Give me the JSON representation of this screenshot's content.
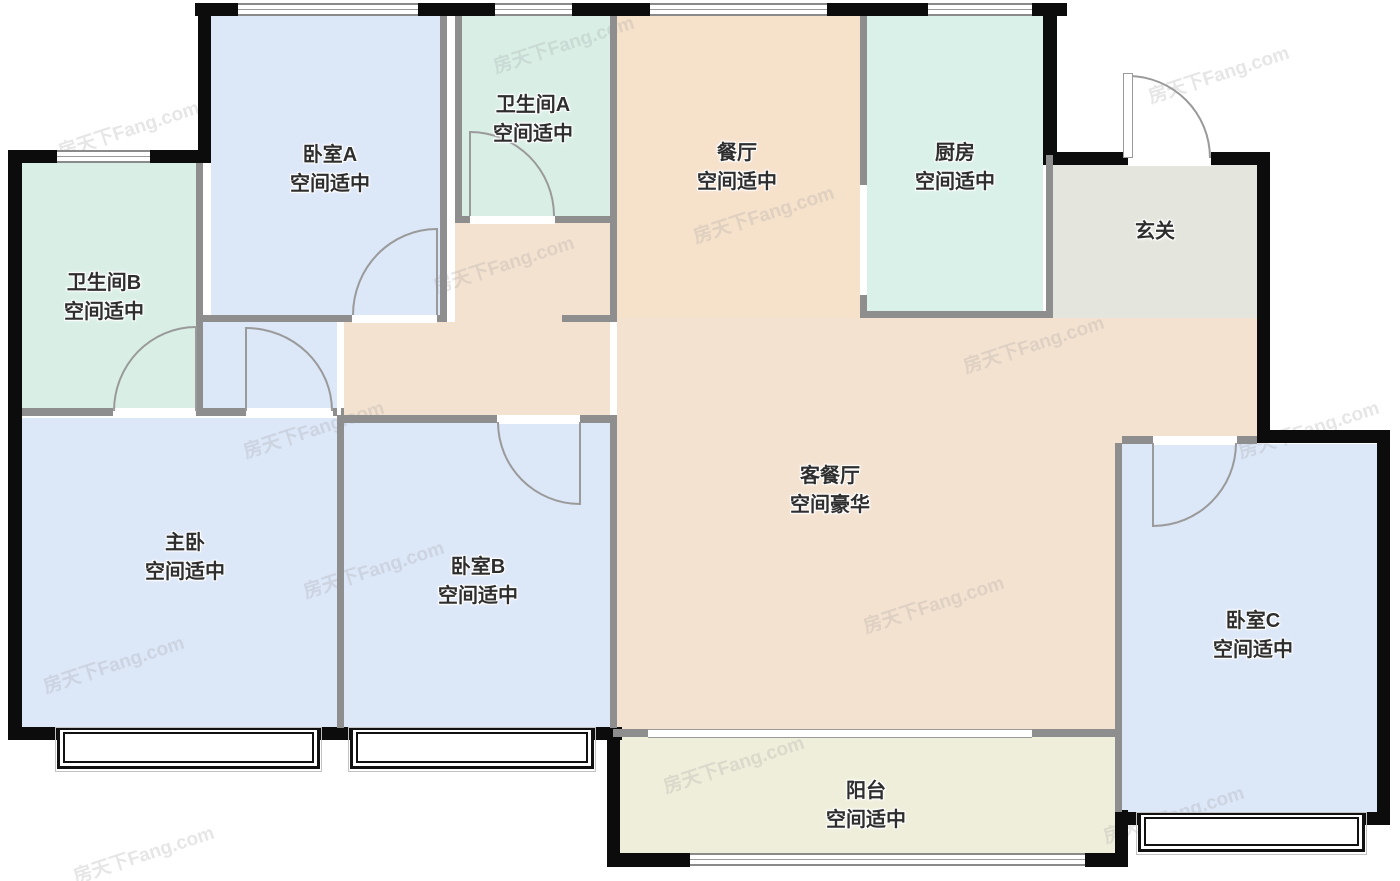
{
  "meta": {
    "watermark_text": "房天下Fang.com"
  },
  "palette": {
    "blue": "#dce7f8",
    "teal": "#d9efe6",
    "kitchen": "#daf1ea",
    "dining": "#f6e1cb",
    "living": "#f4e2d0",
    "foyer": "#e4e6dd",
    "balcony": "#efeeda",
    "wall_black": "#0c0c0c",
    "wall_gray": "#8e8e8e"
  },
  "rooms": [
    {
      "id": "bedroom-a",
      "name": "卧室A",
      "size": "空间适中",
      "lx": 330,
      "ly": 170
    },
    {
      "id": "bathroom-a",
      "name": "卫生间A",
      "size": "空间适中",
      "lx": 533,
      "ly": 120
    },
    {
      "id": "dining",
      "name": "餐厅",
      "size": "空间适中",
      "lx": 737,
      "ly": 168
    },
    {
      "id": "kitchen",
      "name": "厨房",
      "size": "空间适中",
      "lx": 955,
      "ly": 168
    },
    {
      "id": "foyer",
      "name": "玄关",
      "size": "",
      "lx": 1155,
      "ly": 232
    },
    {
      "id": "bathroom-b",
      "name": "卫生间B",
      "size": "空间适中",
      "lx": 104,
      "ly": 298
    },
    {
      "id": "master",
      "name": "主卧",
      "size": "空间适中",
      "lx": 185,
      "ly": 558
    },
    {
      "id": "bedroom-b",
      "name": "卧室B",
      "size": "空间适中",
      "lx": 478,
      "ly": 582
    },
    {
      "id": "living",
      "name": "客餐厅",
      "size": "空间豪华",
      "lx": 830,
      "ly": 491
    },
    {
      "id": "bedroom-c",
      "name": "卧室C",
      "size": "空间适中",
      "lx": 1253,
      "ly": 636
    },
    {
      "id": "balcony",
      "name": "阳台",
      "size": "空间适中",
      "lx": 866,
      "ly": 806
    }
  ],
  "areas": [
    {
      "room": "bedroom-a",
      "color": "blue",
      "rect": [
        211,
        16,
        229,
        299
      ]
    },
    {
      "room": "bathroom-a",
      "color": "teal",
      "rect": [
        462,
        16,
        148,
        200
      ]
    },
    {
      "room": "dining",
      "color": "dining",
      "rect": [
        617,
        16,
        243,
        302
      ]
    },
    {
      "room": "kitchen",
      "color": "kitchen",
      "rect": [
        867,
        16,
        176,
        295
      ]
    },
    {
      "room": "foyer",
      "color": "foyer",
      "rect": [
        1053,
        165,
        204,
        153
      ]
    },
    {
      "room": "bathroom-b",
      "color": "teal",
      "rect": [
        22,
        163,
        174,
        245
      ]
    },
    {
      "room": "living",
      "color": "living",
      "rect": [
        617,
        318,
        640,
        419
      ]
    },
    {
      "room": "corridor",
      "color": "living",
      "rect": [
        344,
        322,
        266,
        93
      ]
    },
    {
      "room": "corridor",
      "color": "living",
      "rect": [
        455,
        223,
        155,
        99
      ]
    },
    {
      "room": "master-vestibule",
      "color": "blue",
      "rect": [
        203,
        322,
        134,
        93
      ]
    },
    {
      "room": "master",
      "color": "blue",
      "rect": [
        22,
        418,
        315,
        309
      ]
    },
    {
      "room": "bedroom-b",
      "color": "blue",
      "rect": [
        344,
        423,
        266,
        304
      ]
    },
    {
      "room": "bedroom-c",
      "color": "blue",
      "rect": [
        1122,
        444,
        255,
        368
      ]
    },
    {
      "room": "balcony",
      "color": "balcony",
      "rect": [
        620,
        737,
        495,
        116
      ]
    }
  ],
  "walls_black": [
    [
      195,
      3,
      43,
      13
    ],
    [
      418,
      3,
      77,
      13
    ],
    [
      572,
      3,
      78,
      13
    ],
    [
      827,
      3,
      101,
      13
    ],
    [
      1032,
      3,
      35,
      13
    ],
    [
      198,
      3,
      13,
      160
    ],
    [
      8,
      150,
      49,
      13
    ],
    [
      150,
      150,
      53,
      13
    ],
    [
      8,
      150,
      14,
      590
    ],
    [
      8,
      727,
      52,
      13
    ],
    [
      320,
      727,
      30,
      13
    ],
    [
      592,
      727,
      30,
      13
    ],
    [
      607,
      727,
      13,
      140
    ],
    [
      607,
      853,
      83,
      14
    ],
    [
      1085,
      853,
      43,
      14
    ],
    [
      1115,
      810,
      13,
      57
    ],
    [
      1043,
      3,
      14,
      152
    ],
    [
      1043,
      152,
      85,
      13
    ],
    [
      1211,
      152,
      59,
      13
    ],
    [
      1257,
      152,
      13,
      291
    ],
    [
      1257,
      430,
      133,
      13
    ],
    [
      1377,
      430,
      13,
      395
    ],
    [
      1352,
      812,
      38,
      13
    ],
    [
      1115,
      812,
      23,
      13
    ]
  ],
  "walls_gray": [
    [
      440,
      16,
      7,
      306
    ],
    [
      455,
      16,
      7,
      207
    ],
    [
      455,
      216,
      15,
      7
    ],
    [
      555,
      216,
      62,
      7
    ],
    [
      610,
      16,
      7,
      306
    ],
    [
      562,
      315,
      55,
      7
    ],
    [
      203,
      315,
      149,
      7
    ],
    [
      437,
      315,
      10,
      7
    ],
    [
      196,
      163,
      7,
      245
    ],
    [
      22,
      408,
      91,
      8
    ],
    [
      196,
      408,
      7,
      8
    ],
    [
      203,
      408,
      43,
      8
    ],
    [
      333,
      408,
      11,
      8
    ],
    [
      344,
      415,
      153,
      8
    ],
    [
      580,
      415,
      37,
      8
    ],
    [
      610,
      415,
      7,
      313
    ],
    [
      337,
      415,
      7,
      313
    ],
    [
      860,
      16,
      7,
      169
    ],
    [
      860,
      295,
      7,
      23
    ],
    [
      860,
      311,
      193,
      7
    ],
    [
      1046,
      155,
      7,
      163
    ],
    [
      1115,
      443,
      7,
      369
    ],
    [
      1122,
      436,
      31,
      8
    ],
    [
      1237,
      436,
      20,
      8
    ],
    [
      613,
      729,
      35,
      8
    ],
    [
      1032,
      729,
      83,
      8
    ],
    [
      839,
      729,
      2,
      9
    ],
    [
      330,
      3,
      2,
      13
    ],
    [
      533,
      3,
      2,
      13
    ],
    [
      738,
      3,
      2,
      13
    ],
    [
      980,
      3,
      2,
      13
    ],
    [
      102,
      150,
      2,
      13
    ],
    [
      885,
      853,
      2,
      13
    ]
  ],
  "walls_white": [
    [
      352,
      315,
      85,
      8
    ],
    [
      470,
      216,
      85,
      8
    ],
    [
      113,
      408,
      83,
      8
    ],
    [
      246,
      408,
      87,
      8
    ],
    [
      497,
      415,
      83,
      9
    ],
    [
      1153,
      436,
      84,
      9
    ],
    [
      1128,
      152,
      83,
      14
    ],
    [
      860,
      185,
      7,
      110
    ],
    [
      447,
      16,
      8,
      207
    ],
    [
      337,
      322,
      4,
      93
    ]
  ],
  "windows": [
    [
      238,
      3,
      180,
      13
    ],
    [
      495,
      3,
      77,
      13
    ],
    [
      650,
      3,
      177,
      13
    ],
    [
      928,
      3,
      104,
      13
    ],
    [
      57,
      150,
      93,
      13
    ],
    [
      690,
      853,
      395,
      13
    ]
  ],
  "bay_windows": [
    [
      57,
      727,
      263,
      42
    ],
    [
      350,
      727,
      244,
      42
    ],
    [
      1138,
      812,
      227,
      40
    ]
  ],
  "sliding_door": [
    648,
    729,
    384,
    9
  ],
  "doors": [
    {
      "room": "bedroom-a",
      "rect": [
        352,
        228,
        85,
        87
      ],
      "corner": "tl"
    },
    {
      "room": "bathroom-a",
      "rect": [
        470,
        131,
        85,
        85
      ],
      "corner": "tr"
    },
    {
      "room": "bathroom-b",
      "rect": [
        113,
        326,
        83,
        85
      ],
      "corner": "tl"
    },
    {
      "room": "master",
      "rect": [
        246,
        327,
        87,
        84
      ],
      "corner": "tr"
    },
    {
      "room": "bedroom-b",
      "rect": [
        497,
        422,
        83,
        83
      ],
      "corner": "bl"
    },
    {
      "room": "bedroom-c",
      "rect": [
        1153,
        443,
        84,
        84
      ],
      "corner": "br"
    },
    {
      "room": "entry",
      "rect": [
        1128,
        75,
        83,
        83
      ],
      "corner": "tr"
    }
  ],
  "door_leaves": [
    [
      436,
      228,
      2,
      87
    ],
    [
      469,
      131,
      2,
      85
    ],
    [
      195,
      326,
      2,
      85
    ],
    [
      245,
      327,
      2,
      84
    ],
    [
      579,
      422,
      2,
      83
    ],
    [
      1152,
      443,
      2,
      84
    ]
  ],
  "entry_leaf": [
    1123,
    73,
    10,
    85
  ],
  "watermarks": [
    [
      55,
      115
    ],
    [
      430,
      250
    ],
    [
      240,
      415
    ],
    [
      690,
      200
    ],
    [
      1145,
      60
    ],
    [
      1235,
      415
    ],
    [
      40,
      650
    ],
    [
      300,
      555
    ],
    [
      860,
      590
    ],
    [
      660,
      750
    ],
    [
      1100,
      800
    ],
    [
      490,
      30
    ],
    [
      960,
      330
    ],
    [
      70,
      840
    ]
  ]
}
